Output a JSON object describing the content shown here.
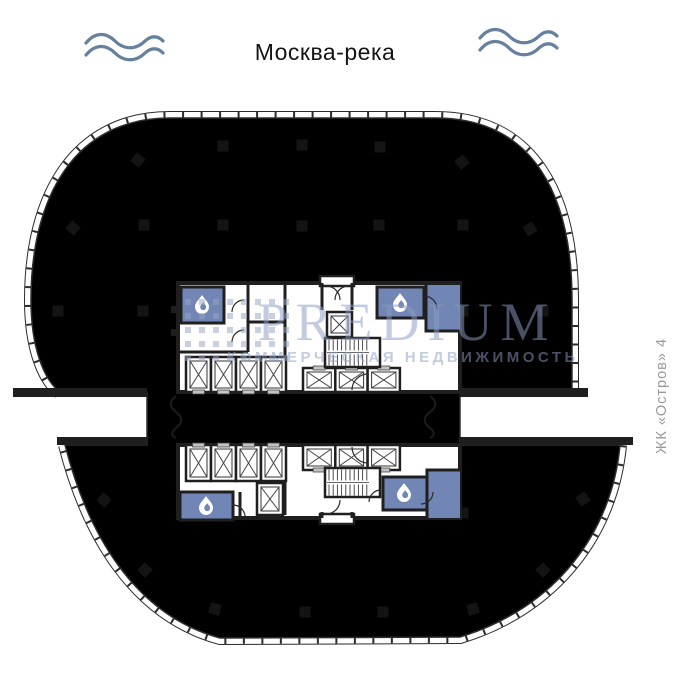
{
  "header": {
    "river_label": "Москва-река"
  },
  "side_label": {
    "text": "ЖК «Остров» 4"
  },
  "watermark": {
    "brand": "PREDIUM",
    "tagline": "КОММЕРЧЕСКАЯ НЕДВИЖИМОСТЬ",
    "logo_dots": {
      "x0": 185,
      "y0": 299,
      "dx": 14,
      "dy": 14,
      "cols": 8,
      "rows": 5,
      "size": 6
    }
  },
  "colors": {
    "plate": "#7186b4",
    "wall": "#1f1f1f",
    "wave": "#66819f",
    "watermark": "#8b9cc2",
    "side_label": "#9a9a9a",
    "shaft_fill": "#ffffff",
    "door_mark": "#c2c2c2"
  },
  "plan": {
    "columns": [
      {
        "x": 138,
        "y": 160,
        "r": 40
      },
      {
        "x": 223,
        "y": 146,
        "r": 0
      },
      {
        "x": 302,
        "y": 145,
        "r": 0
      },
      {
        "x": 380,
        "y": 147,
        "r": 0
      },
      {
        "x": 462,
        "y": 162,
        "r": -40
      },
      {
        "x": 73,
        "y": 228,
        "r": 40
      },
      {
        "x": 144,
        "y": 225,
        "r": 0
      },
      {
        "x": 223,
        "y": 225,
        "r": 0
      },
      {
        "x": 302,
        "y": 226,
        "r": 0
      },
      {
        "x": 379,
        "y": 225,
        "r": 0
      },
      {
        "x": 463,
        "y": 225,
        "r": 0
      },
      {
        "x": 530,
        "y": 229,
        "r": -30
      },
      {
        "x": 58,
        "y": 311,
        "r": 0
      },
      {
        "x": 143,
        "y": 311,
        "r": 0
      },
      {
        "x": 463,
        "y": 311,
        "r": 0
      },
      {
        "x": 543,
        "y": 311,
        "r": 0
      },
      {
        "x": 104,
        "y": 500,
        "r": 40
      },
      {
        "x": 463,
        "y": 513,
        "r": 0
      },
      {
        "x": 583,
        "y": 499,
        "r": -35
      },
      {
        "x": 145,
        "y": 570,
        "r": 45
      },
      {
        "x": 543,
        "y": 570,
        "r": -45
      },
      {
        "x": 215,
        "y": 609,
        "r": 15
      },
      {
        "x": 305,
        "y": 612,
        "r": 0
      },
      {
        "x": 383,
        "y": 612,
        "r": 0
      },
      {
        "x": 473,
        "y": 609,
        "r": -15
      }
    ],
    "elevator_shafts": [
      {
        "x": 186,
        "y": 357,
        "w": 25,
        "h": 35,
        "door": "bottom"
      },
      {
        "x": 211,
        "y": 357,
        "w": 25,
        "h": 35,
        "door": "bottom"
      },
      {
        "x": 236,
        "y": 357,
        "w": 25,
        "h": 35,
        "door": "bottom"
      },
      {
        "x": 261,
        "y": 357,
        "w": 25,
        "h": 35,
        "door": "bottom"
      },
      {
        "x": 303,
        "y": 368,
        "w": 32.3,
        "h": 24,
        "door": "top"
      },
      {
        "x": 335.3,
        "y": 368,
        "w": 32.3,
        "h": 24,
        "door": "top"
      },
      {
        "x": 367.6,
        "y": 368,
        "w": 32.3,
        "h": 24,
        "door": "top"
      },
      {
        "x": 327,
        "y": 312,
        "w": 25,
        "h": 25,
        "door": "none"
      },
      {
        "x": 186,
        "y": 445,
        "w": 25,
        "h": 36,
        "door": "top"
      },
      {
        "x": 211,
        "y": 445,
        "w": 25,
        "h": 36,
        "door": "top"
      },
      {
        "x": 236,
        "y": 445,
        "w": 25,
        "h": 36,
        "door": "top"
      },
      {
        "x": 261,
        "y": 445,
        "w": 25,
        "h": 36,
        "door": "top"
      },
      {
        "x": 303,
        "y": 445,
        "w": 32.3,
        "h": 25,
        "door": "bottom"
      },
      {
        "x": 335.3,
        "y": 445,
        "w": 32.3,
        "h": 25,
        "door": "bottom"
      },
      {
        "x": 367.6,
        "y": 445,
        "w": 32.3,
        "h": 25,
        "door": "bottom"
      },
      {
        "x": 257,
        "y": 483,
        "w": 26,
        "h": 32,
        "door": "none"
      }
    ],
    "staircases": [
      {
        "x": 325,
        "y": 338,
        "w": 55,
        "h": 29
      },
      {
        "x": 325,
        "y": 468,
        "w": 55,
        "h": 29
      }
    ],
    "wet_rooms": [
      {
        "x": 181,
        "y": 287,
        "w": 43,
        "h": 36
      },
      {
        "x": 377,
        "y": 287,
        "w": 47,
        "h": 31
      },
      {
        "x": 180,
        "y": 492,
        "w": 53,
        "h": 28
      },
      {
        "x": 383,
        "y": 477,
        "w": 44,
        "h": 33
      }
    ],
    "droplets": [
      {
        "x": 202,
        "y": 303
      },
      {
        "x": 400,
        "y": 301
      },
      {
        "x": 206,
        "y": 504
      },
      {
        "x": 404,
        "y": 491
      }
    ]
  }
}
